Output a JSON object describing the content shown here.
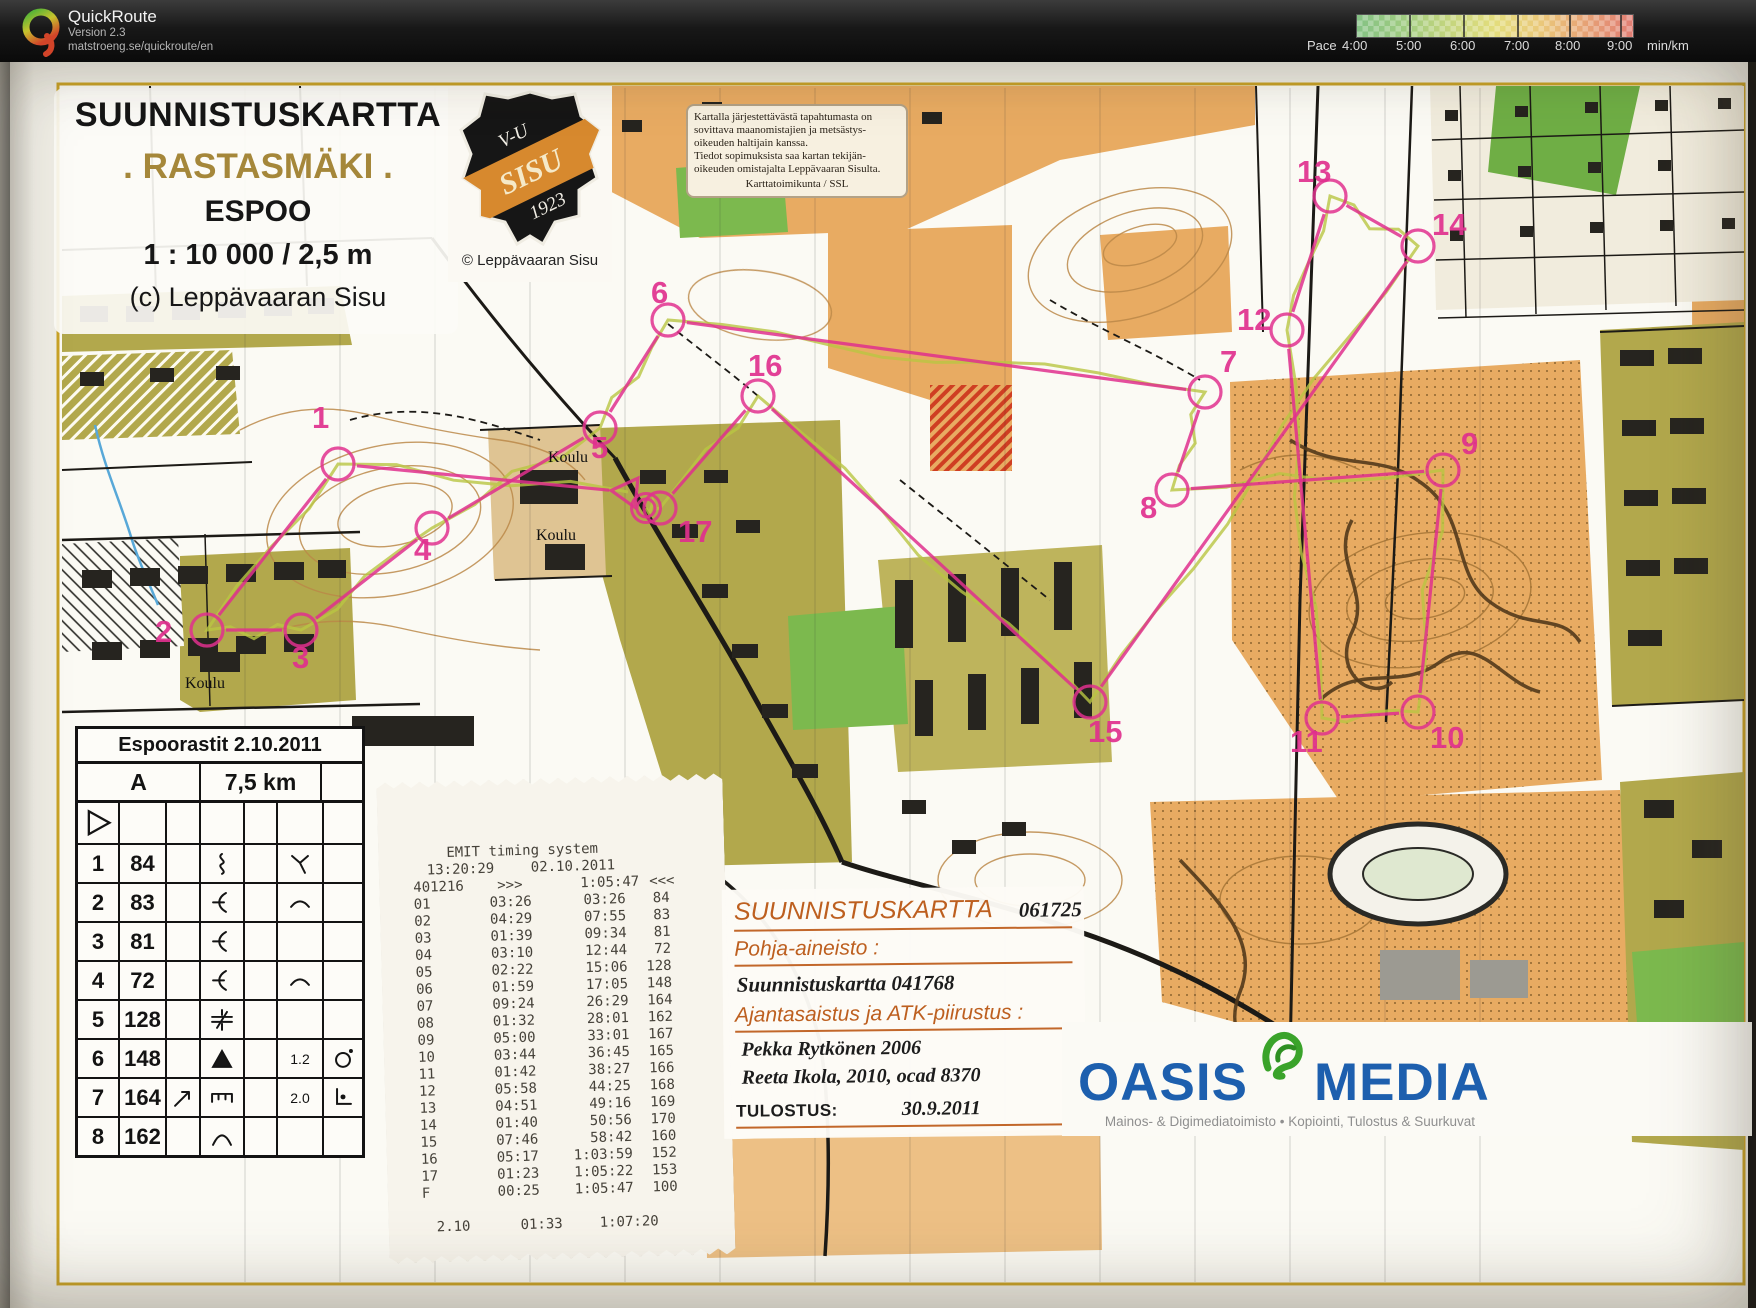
{
  "header": {
    "app_name": "QuickRoute",
    "version": "Version 2.3",
    "url": "matstroeng.se/quickroute/en",
    "pace_label": "Pace",
    "pace_ticks": [
      "4:00",
      "5:00",
      "6:00",
      "7:00",
      "8:00",
      "9:00"
    ],
    "pace_unit": "min/km"
  },
  "map_title": {
    "title": "SUUNNISTUSKARTTA",
    "name": ". RASTASMÄKI .",
    "city": "ESPOO",
    "scale": "1 : 10 000 / 2,5 m",
    "copyright": "(c) Leppävaaran Sisu"
  },
  "badge": {
    "top": "V-U",
    "band": "SISU",
    "year": "1923",
    "caption": "© Leppävaaran Sisu"
  },
  "disclaimer": {
    "lines": [
      "Kartalla järjestettävästä tapahtumasta on",
      "sovittava maanomistajien ja metsästys-",
      "oikeuden haltijain kanssa.",
      "Tiedot sopimuksista saa kartan tekijän-",
      "oikeuden omistajalta Leppävaaran Sisulta.",
      "Karttatoimikunta / SSL"
    ]
  },
  "control_card": {
    "title": "Espoorastit 2.10.2011",
    "course": "A",
    "length": "7,5 km",
    "rows": [
      {
        "type": "start"
      },
      {
        "n": "1",
        "code": "84",
        "c": "",
        "d": "gully",
        "e": "",
        "f": "junction-y",
        "g": ""
      },
      {
        "n": "2",
        "code": "83",
        "c": "",
        "d": "reentrant",
        "e": "",
        "f": "arc",
        "g": ""
      },
      {
        "n": "3",
        "code": "81",
        "c": "",
        "d": "reentrant",
        "e": "",
        "f": "",
        "g": ""
      },
      {
        "n": "4",
        "code": "72",
        "c": "",
        "d": "reentrant",
        "e": "",
        "f": "arc",
        "g": ""
      },
      {
        "n": "5",
        "code": "128",
        "c": "",
        "d": "crossing",
        "e": "",
        "f": "",
        "g": ""
      },
      {
        "n": "6",
        "code": "148",
        "c": "",
        "d": "boulder",
        "e": "",
        "f": "1.2",
        "g": "circle-dot"
      },
      {
        "n": "7",
        "code": "164",
        "c": "arrow-ne",
        "d": "wall",
        "e": "",
        "f": "2.0",
        "g": "corner-dot"
      },
      {
        "n": "8",
        "code": "162",
        "c": "",
        "d": "knoll",
        "e": "",
        "f": "",
        "g": ""
      }
    ]
  },
  "receipt": {
    "title": "EMIT timing system",
    "time": "13:20:29",
    "date": "02.10.2011",
    "card": "401216",
    "arrows_out": ">>>",
    "total": "1:05:47",
    "arrows_in": "<<<",
    "splits": [
      {
        "leg": "01",
        "split": "03:26",
        "cum": "03:26",
        "code": "84"
      },
      {
        "leg": "02",
        "split": "04:29",
        "cum": "07:55",
        "code": "83"
      },
      {
        "leg": "03",
        "split": "01:39",
        "cum": "09:34",
        "code": "81"
      },
      {
        "leg": "04",
        "split": "03:10",
        "cum": "12:44",
        "code": "72"
      },
      {
        "leg": "05",
        "split": "02:22",
        "cum": "15:06",
        "code": "128"
      },
      {
        "leg": "06",
        "split": "01:59",
        "cum": "17:05",
        "code": "148"
      },
      {
        "leg": "07",
        "split": "09:24",
        "cum": "26:29",
        "code": "164"
      },
      {
        "leg": "08",
        "split": "01:32",
        "cum": "28:01",
        "code": "162"
      },
      {
        "leg": "09",
        "split": "05:00",
        "cum": "33:01",
        "code": "167"
      },
      {
        "leg": "10",
        "split": "03:44",
        "cum": "36:45",
        "code": "165"
      },
      {
        "leg": "11",
        "split": "01:42",
        "cum": "38:27",
        "code": "166"
      },
      {
        "leg": "12",
        "split": "05:58",
        "cum": "44:25",
        "code": "168"
      },
      {
        "leg": "13",
        "split": "04:51",
        "cum": "49:16",
        "code": "169"
      },
      {
        "leg": "14",
        "split": "01:40",
        "cum": "50:56",
        "code": "170"
      },
      {
        "leg": "15",
        "split": "07:46",
        "cum": "58:42",
        "code": "160"
      },
      {
        "leg": "16",
        "split": "05:17",
        "cum": "1:03:59",
        "code": "152"
      },
      {
        "leg": "17",
        "split": "01:23",
        "cum": "1:05:22",
        "code": "153"
      },
      {
        "leg": "F",
        "split": "00:25",
        "cum": "1:05:47",
        "code": "100"
      }
    ],
    "summary": {
      "a": "2.10",
      "b": "01:33",
      "c": "1:07:20"
    }
  },
  "info_box": {
    "title": "SUUNNISTUSKARTTA",
    "serial": "061725",
    "base_label": "Pohja-aineisto :",
    "base_value": "Suunnistuskartta 041768",
    "update_label": "Ajantasaistus ja ATK-piirustus :",
    "author1": "Pekka Rytkönen 2006",
    "author2": "Reeta Ikola, 2010,  ocad 8370",
    "print_label": "TULOSTUS:",
    "print_date": "30.9.2011"
  },
  "printer_logo": {
    "name1": "OASIS",
    "name2": "MEDIA",
    "tagline": "Mainos- & Digimediatoimisto • Kopiointi, Tulostus & Suurkuvat"
  },
  "map_labels": {
    "koulu": [
      {
        "text": "Koulu",
        "x": 548,
        "y": 462
      },
      {
        "text": "Koulu",
        "x": 536,
        "y": 540
      },
      {
        "text": "Koulu",
        "x": 185,
        "y": 688
      }
    ]
  },
  "course": {
    "color": "#e0308e",
    "start": {
      "x": 628,
      "y": 492
    },
    "finish": {
      "x": 646,
      "y": 508
    },
    "controls": [
      {
        "n": "1",
        "cx": 338,
        "cy": 464,
        "lx": 312,
        "ly": 428
      },
      {
        "n": "2",
        "cx": 207,
        "cy": 630,
        "lx": 155,
        "ly": 642
      },
      {
        "n": "3",
        "cx": 301,
        "cy": 630,
        "lx": 292,
        "ly": 668
      },
      {
        "n": "4",
        "cx": 432,
        "cy": 528,
        "lx": 414,
        "ly": 560
      },
      {
        "n": "5",
        "cx": 600,
        "cy": 428,
        "lx": 591,
        "ly": 458
      },
      {
        "n": "6",
        "cx": 668,
        "cy": 320,
        "lx": 651,
        "ly": 303
      },
      {
        "n": "7",
        "cx": 1205,
        "cy": 392,
        "lx": 1220,
        "ly": 372
      },
      {
        "n": "8",
        "cx": 1172,
        "cy": 490,
        "lx": 1140,
        "ly": 518
      },
      {
        "n": "9",
        "cx": 1443,
        "cy": 470,
        "lx": 1461,
        "ly": 454
      },
      {
        "n": "10",
        "cx": 1418,
        "cy": 712,
        "lx": 1430,
        "ly": 748
      },
      {
        "n": "11",
        "cx": 1322,
        "cy": 718,
        "lx": 1290,
        "ly": 752
      },
      {
        "n": "12",
        "cx": 1287,
        "cy": 330,
        "lx": 1237,
        "ly": 330
      },
      {
        "n": "13",
        "cx": 1330,
        "cy": 196,
        "lx": 1297,
        "ly": 182
      },
      {
        "n": "14",
        "cx": 1418,
        "cy": 246,
        "lx": 1432,
        "ly": 235
      },
      {
        "n": "15",
        "cx": 1090,
        "cy": 702,
        "lx": 1088,
        "ly": 742
      },
      {
        "n": "16",
        "cx": 758,
        "cy": 396,
        "lx": 748,
        "ly": 376
      },
      {
        "n": "17",
        "cx": 660,
        "cy": 508,
        "lx": 678,
        "ly": 542
      }
    ]
  }
}
